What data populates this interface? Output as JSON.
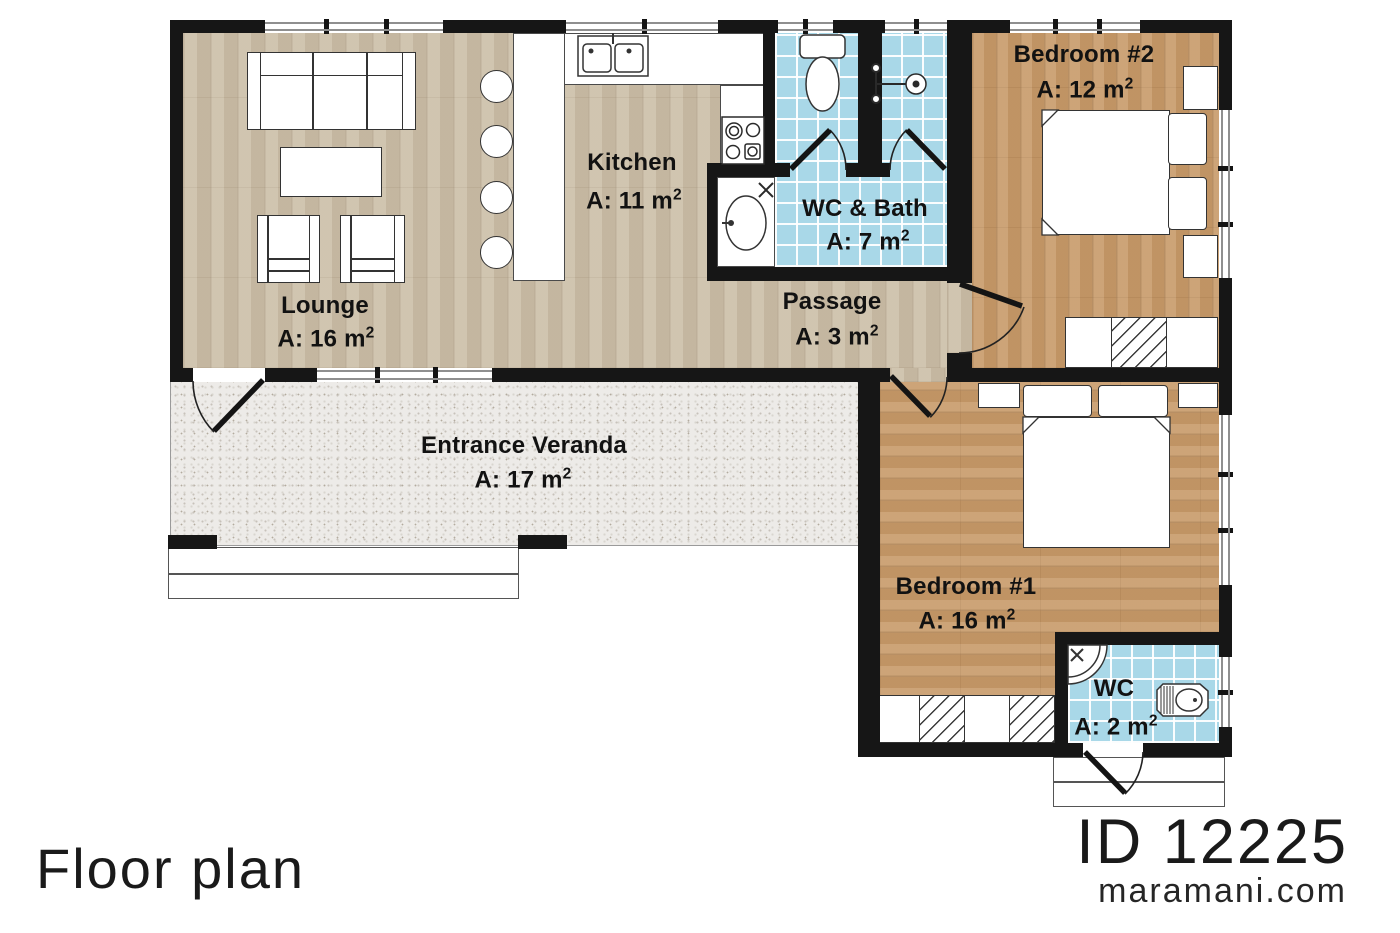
{
  "brand": {
    "plan_title": "Floor plan",
    "plan_id": "ID 12225",
    "website": "maramani.com"
  },
  "rooms": {
    "lounge": {
      "name": "Lounge",
      "area": "A: 16 m",
      "sup": "2"
    },
    "kitchen": {
      "name": "Kitchen",
      "area": "A: 11 m",
      "sup": "2"
    },
    "wc_bath": {
      "name": "WC & Bath",
      "area": "A: 7 m",
      "sup": "2"
    },
    "passage": {
      "name": "Passage",
      "area": "A: 3 m",
      "sup": "2"
    },
    "veranda": {
      "name": "Entrance Veranda",
      "area": "A: 17 m",
      "sup": "2"
    },
    "bedroom2": {
      "name": "Bedroom #2",
      "area": "A: 12 m",
      "sup": "2"
    },
    "bedroom1": {
      "name": "Bedroom #1",
      "area": "A: 16 m",
      "sup": "2"
    },
    "wc": {
      "name": "WC",
      "area": "A: 2 m",
      "sup": "2"
    }
  },
  "colors": {
    "wall": "#161616",
    "wood_light": "#ccbfa8",
    "wood_dark": "#c79a69",
    "tile_blue": "#a9d8e8",
    "veranda_gray": "#edebe8"
  }
}
